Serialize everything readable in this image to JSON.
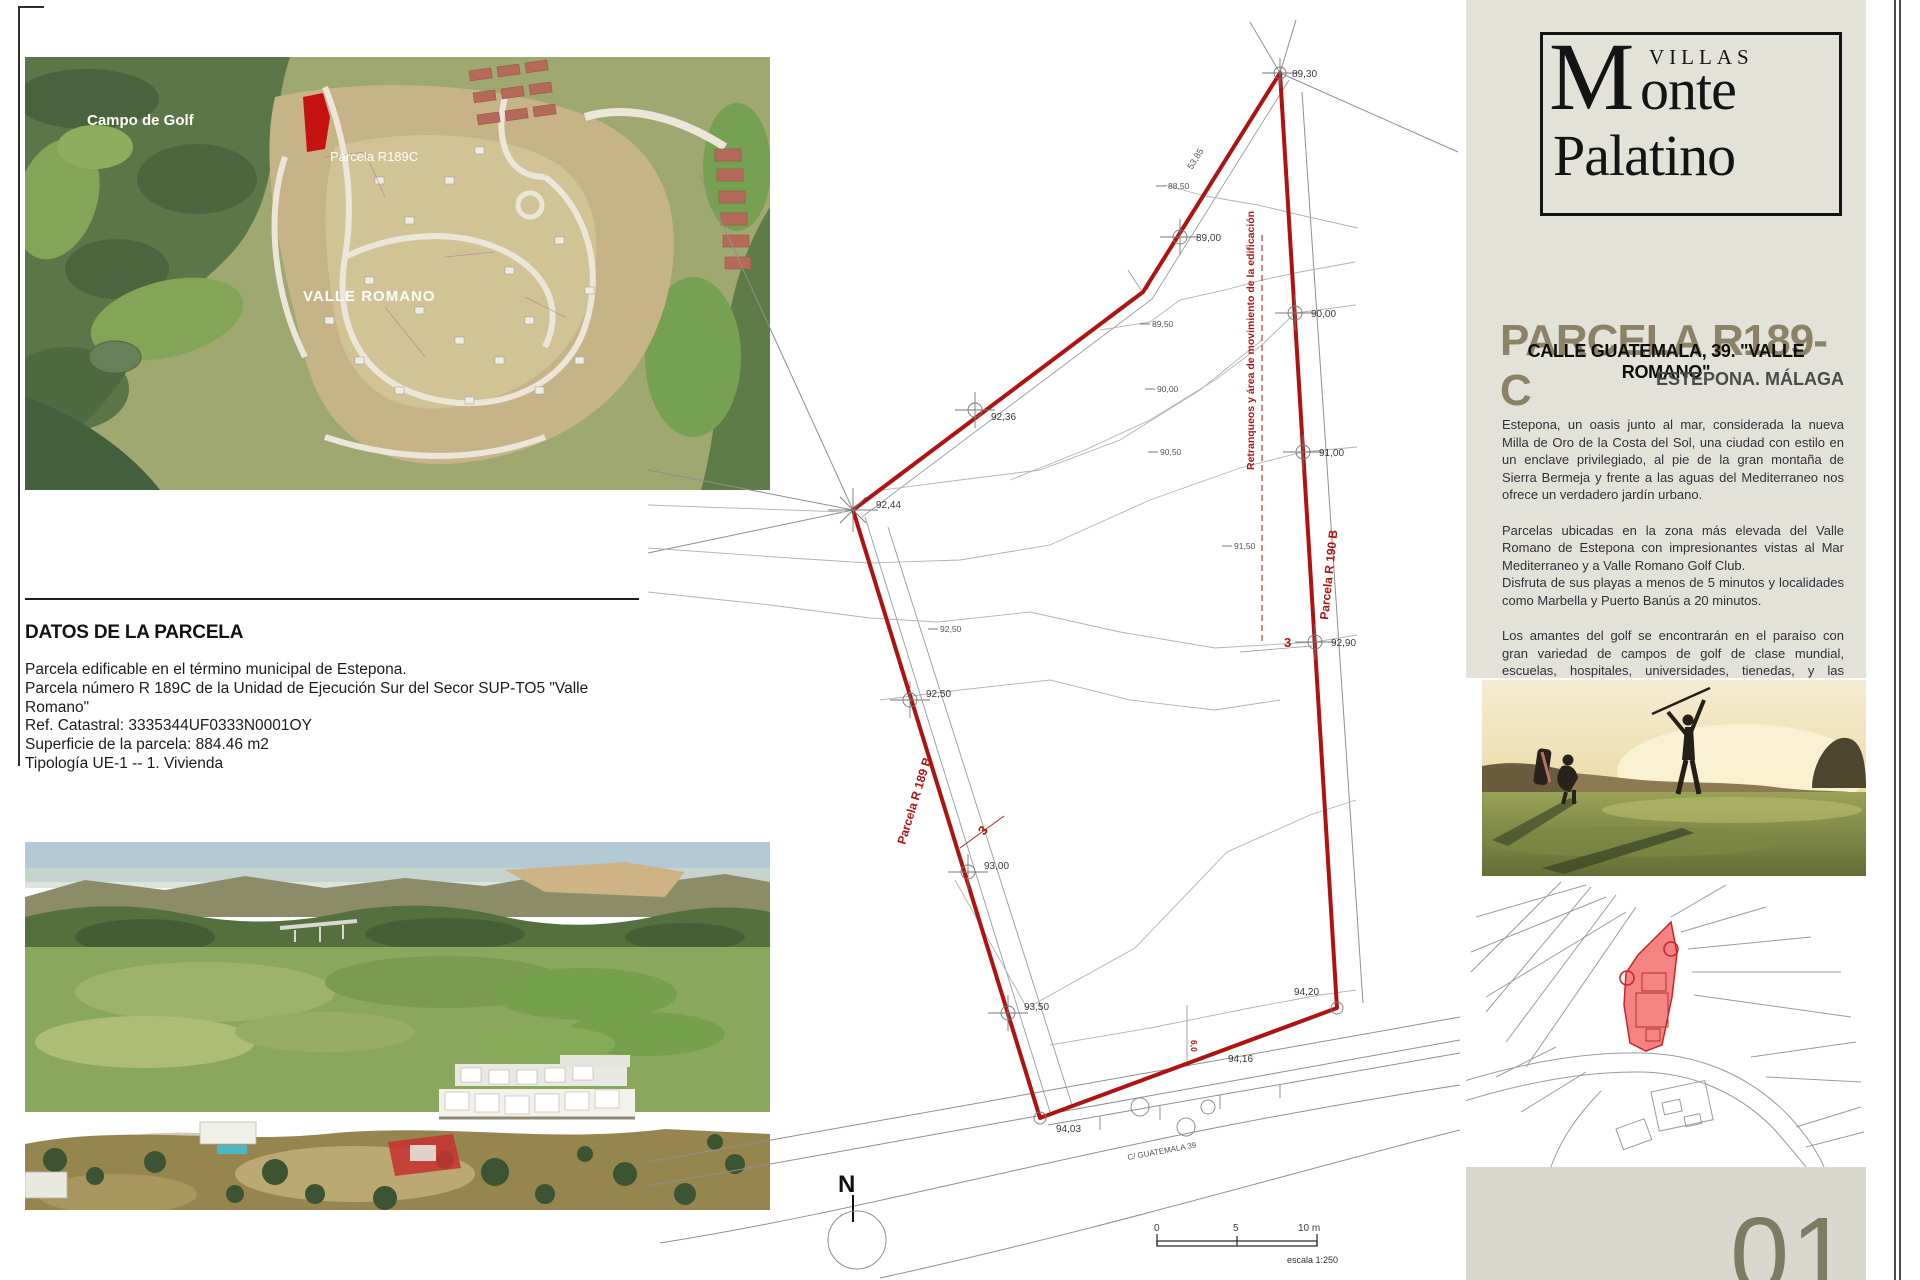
{
  "colors": {
    "accent_red": "#b01212",
    "panel_beige": "#e3e2d9",
    "title_olive": "#8c8266",
    "page_number_olive": "#7e7b63",
    "minimap_parcel_fill": "#f48484"
  },
  "left_column": {
    "satellite_map": {
      "labels": {
        "campo_de_golf": "Campo de Golf",
        "parcela": "Parcela R189C",
        "valle_romano": "VALLE ROMANO"
      }
    },
    "datos": {
      "heading": "DATOS DE LA PARCELA",
      "line1": "Parcela edificable en el término municipal de Estepona.",
      "line2": "Parcela número R 189C de la Unidad de Ejecución Sur del Secor SUP-TO5 \"Valle Romano\"",
      "ref_catastral": "Ref. Catastral: 3335344UF0333N0001OY",
      "superficie": "Superficie de la parcela: 884.46 m2",
      "tipologia": "Tipología UE-1 -- 1. Vivienda"
    }
  },
  "site_plan": {
    "parcel_labels": {
      "r190b": "Parcela R 190 B",
      "r189b": "Parcela R 189 B"
    },
    "retranqueos": "Retranqueos y área de movimiento de la edificación",
    "street": "C/ GUATEMALA 39",
    "north": "N",
    "setback_left": "3",
    "setback_right": "3",
    "setback_road": "6,0",
    "edge_dimension": "53,85",
    "scale_bar": {
      "zero": "0",
      "five": "5",
      "ten": "10 m",
      "escala": "escala 1:250"
    },
    "elevation_markers": [
      {
        "label": "89,30"
      },
      {
        "label": "89,00"
      },
      {
        "label": "90,00"
      },
      {
        "label": "91,00"
      },
      {
        "label": "92,90"
      },
      {
        "label": "92,36"
      },
      {
        "label": "92,44"
      },
      {
        "label": "92,50"
      },
      {
        "label": "93,00"
      },
      {
        "label": "93,50"
      },
      {
        "label": "94,03"
      },
      {
        "label": "94,20"
      },
      {
        "label": "94,16"
      }
    ],
    "contour_labels": [
      {
        "label": "88,50"
      },
      {
        "label": "89,50"
      },
      {
        "label": "90,00"
      },
      {
        "label": "90,50"
      },
      {
        "label": "91,50"
      },
      {
        "label": "92,50"
      }
    ]
  },
  "right_column": {
    "logo": {
      "villas": "VILLAS",
      "monte": "Monte",
      "palatino": "Palatino"
    },
    "title": "PARCELA R189-C",
    "subtitle": "CALLE GUATEMALA, 39. \"VALLE ROMANO\"",
    "location": "ESTEPONA. MÁLAGA",
    "paragraphs": [
      "Estepona, un oasis junto al mar, considerada la nueva Milla de Oro de la Costa del Sol, una ciudad con estilo en un enclave privilegiado, al pie de la gran montaña de Sierra Bermeja y frente a las aguas del Mediterraneo nos ofrece un verdadero jardín urbano.",
      "Parcelas ubicadas en la zona más elevada del Valle Romano de Estepona con impresionantes vistas al Mar Mediterraneo y a Valle Romano Golf Club.\nDisfruta de sus playas a menos de 5 minutos y localidades como Marbella y Puerto Banús a 20 minutos.",
      "Los amantes del golf se encontrarán en el paraíso con gran variedad de campos de golf de clase mundial, escuelas, hospitales, universidades, tienedas, y las mejores ofertas gastronómicas con restaurantes de reconocido mérito."
    ],
    "page_number": "01"
  }
}
